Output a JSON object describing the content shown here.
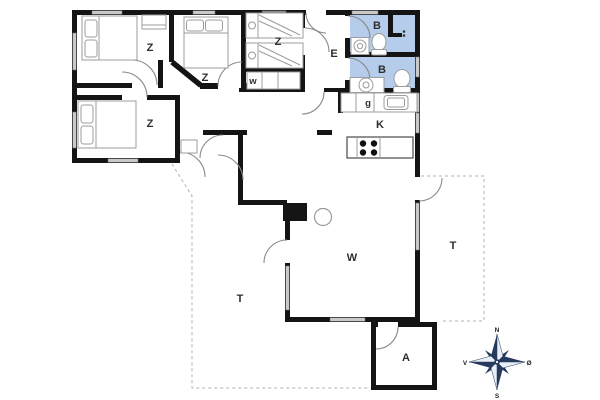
{
  "floor_plan": {
    "rooms": {
      "bedroom_top_left": {
        "label": "Z"
      },
      "bedroom_top_middle": {
        "label": "Z"
      },
      "bedroom_bunks": {
        "label": "Z"
      },
      "bedroom_bottom_left": {
        "label": "Z"
      },
      "entrance_hall": {
        "label": "E"
      },
      "bathroom_top": {
        "label": "B"
      },
      "bathroom_bottom": {
        "label": "B"
      },
      "wardrobe": {
        "label": "w"
      },
      "utility": {
        "label": "g"
      },
      "kitchen": {
        "label": "K"
      },
      "living_room": {
        "label": "W"
      },
      "terrace_west": {
        "label": "T"
      },
      "terrace_east": {
        "label": "T"
      },
      "annex": {
        "label": "A"
      }
    },
    "compass": {
      "north": "N",
      "east": "Ø",
      "south": "S",
      "west": "V"
    },
    "colors": {
      "walls": "#141414",
      "bathroom_fill": "#b5cdea",
      "window_fill": "#c9c9c9",
      "door_arc": "#8a8a8a",
      "terrace_dash": "#b0b0b0",
      "compass_dark": "#263a5e"
    }
  }
}
